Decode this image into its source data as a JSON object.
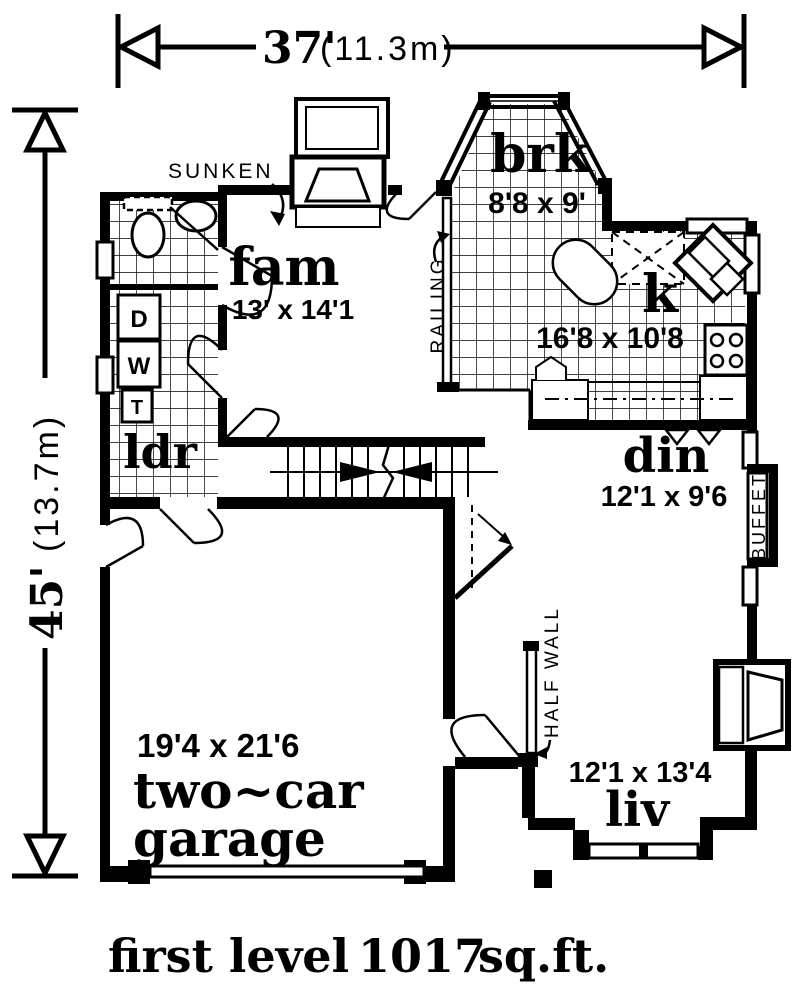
{
  "page": {
    "background": "#ffffff",
    "ink": "#000000"
  },
  "dimensions": {
    "width": {
      "feet": "37'",
      "meters": "(11.3m)"
    },
    "height": {
      "feet": "45'",
      "meters": "(13.7m)"
    }
  },
  "rooms": {
    "breakfast": {
      "name": "brk",
      "size": "8'8 x 9'"
    },
    "family": {
      "name": "fam",
      "size": "13' x 14'1"
    },
    "kitchen": {
      "name": "k",
      "size": "16'8 x 10'8"
    },
    "dining": {
      "name": "din",
      "size": "12'1 x 9'6"
    },
    "laundry": {
      "name": "ldr"
    },
    "garage": {
      "name_line1": "two~car",
      "name_line2": "garage",
      "size": "19'4 x 21'6"
    },
    "living": {
      "name": "liv",
      "size": "12'1 x 13'4"
    }
  },
  "annotations": {
    "sunken": "SUNKEN",
    "railing": "RAILING",
    "half_wall": "HALF WALL",
    "buffet": "BUFFET"
  },
  "appliances": {
    "dryer": "D",
    "washer": "W",
    "tub": "T"
  },
  "footer": {
    "level": "first level",
    "area": "1017",
    "unit": "sq.ft."
  }
}
